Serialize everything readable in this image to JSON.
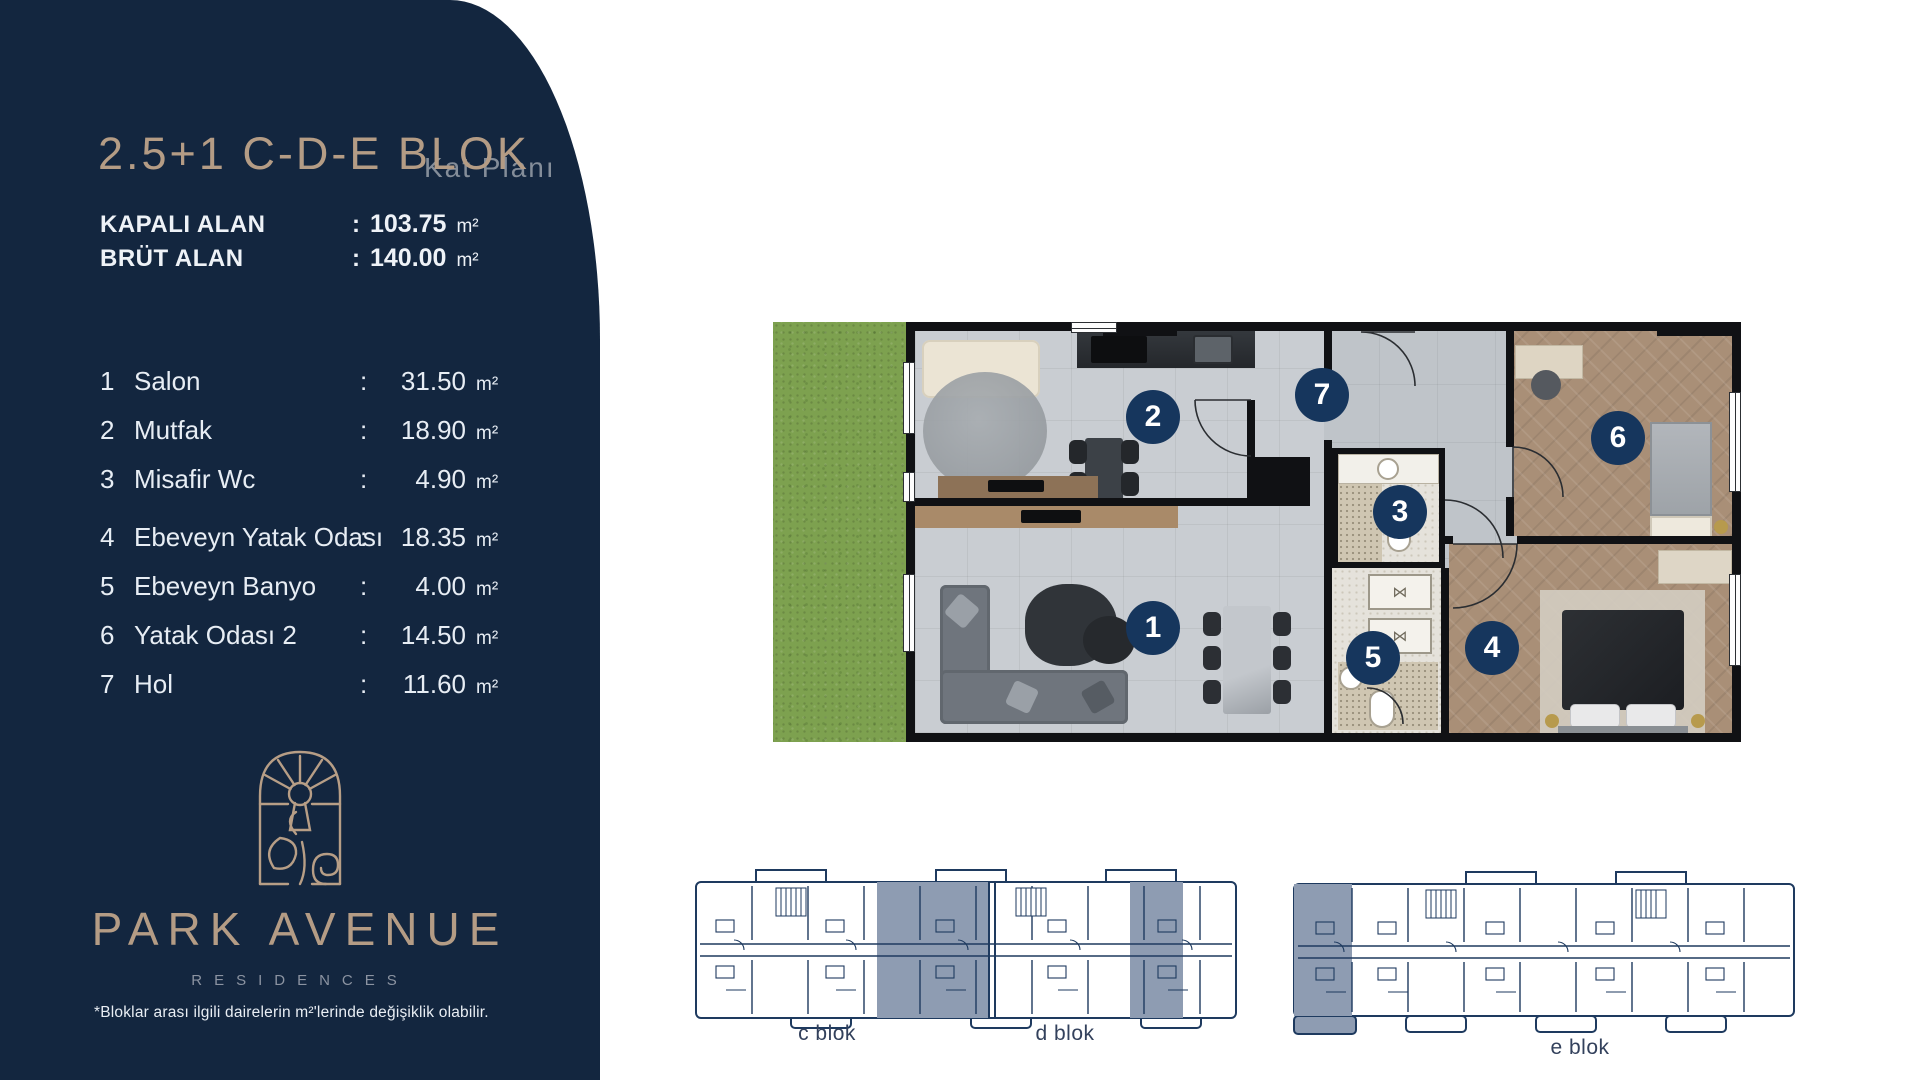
{
  "sidebar": {
    "title": "2.5+1 C-D-E BLOK",
    "subtitle": "Kat Planı",
    "summary": [
      {
        "label": "KAPALI ALAN",
        "value": "103.75"
      },
      {
        "label": "BRÜT ALAN",
        "value": "140.00"
      }
    ],
    "rooms": [
      {
        "num": "1",
        "name": "Salon",
        "area": "31.50"
      },
      {
        "num": "2",
        "name": "Mutfak",
        "area": "18.90"
      },
      {
        "num": "3",
        "name": "Misafir Wc",
        "area": "4.90"
      },
      {
        "num": "4",
        "name": "Ebeveyn Yatak Odası",
        "area": "18.35"
      },
      {
        "num": "5",
        "name": "Ebeveyn Banyo",
        "area": "4.00"
      },
      {
        "num": "6",
        "name": "Yatak Odası 2",
        "area": "14.50"
      },
      {
        "num": "7",
        "name": "Hol",
        "area": "11.60"
      }
    ],
    "labels": {
      "colon": ":",
      "unit": "m²"
    },
    "logo": {
      "line1": "PARK AVENUE",
      "line2": "RESIDENCES"
    },
    "footnote": "*Bloklar arası ilgili dairelerin m²'lerinde değişiklik olabilir."
  },
  "blocks": {
    "c": "c blok",
    "d": "d blok",
    "e": "e blok"
  },
  "colors": {
    "sidebar_navy": "#13263f",
    "title_tan": "#b49c85",
    "subtitle_gray": "#848d99",
    "badge_navy": "#16365d",
    "diagram_line": "#1e3a5f",
    "diagram_highlight": "#8e9cb2",
    "grass_green": "#7da14f"
  }
}
